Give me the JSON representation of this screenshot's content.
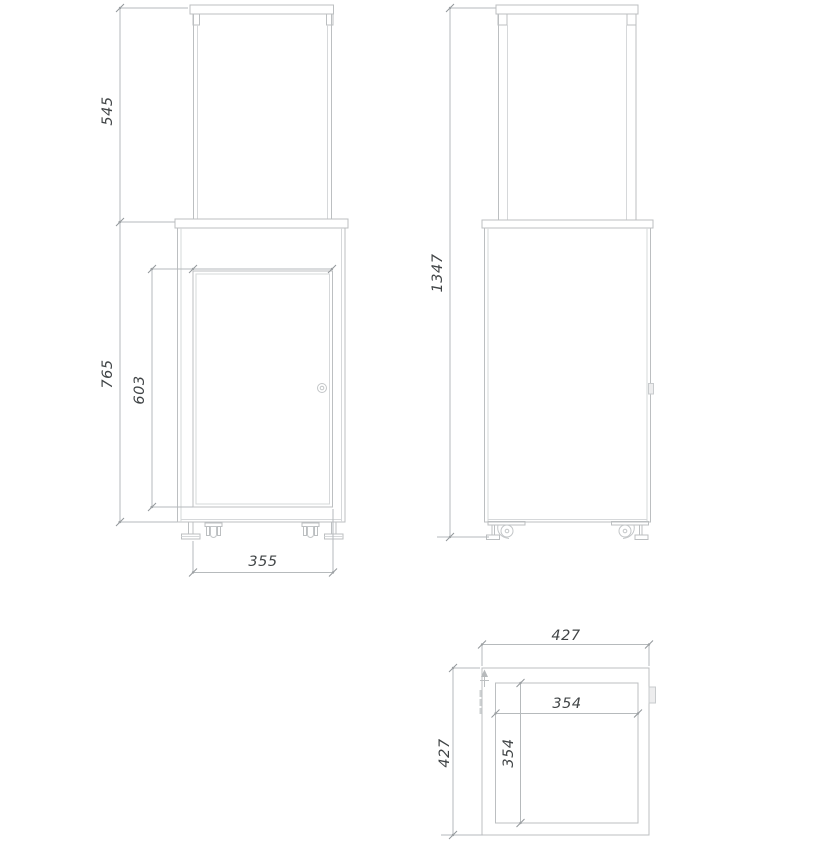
{
  "drawing": {
    "type": "technical-orthographic-views",
    "colors": {
      "object_line": "#bcbfc1",
      "light_line": "#d6d8da",
      "dimension_line": "#b6babc",
      "text": "#404446",
      "background": "#ffffff"
    },
    "dimensions": {
      "front": {
        "glass_height": "545",
        "body_height": "765",
        "door_height": "603",
        "base_width": "355"
      },
      "side": {
        "total_height": "1347"
      },
      "top": {
        "outer_width": "427",
        "outer_depth": "427",
        "inner_width": "354",
        "inner_depth": "354"
      }
    }
  }
}
